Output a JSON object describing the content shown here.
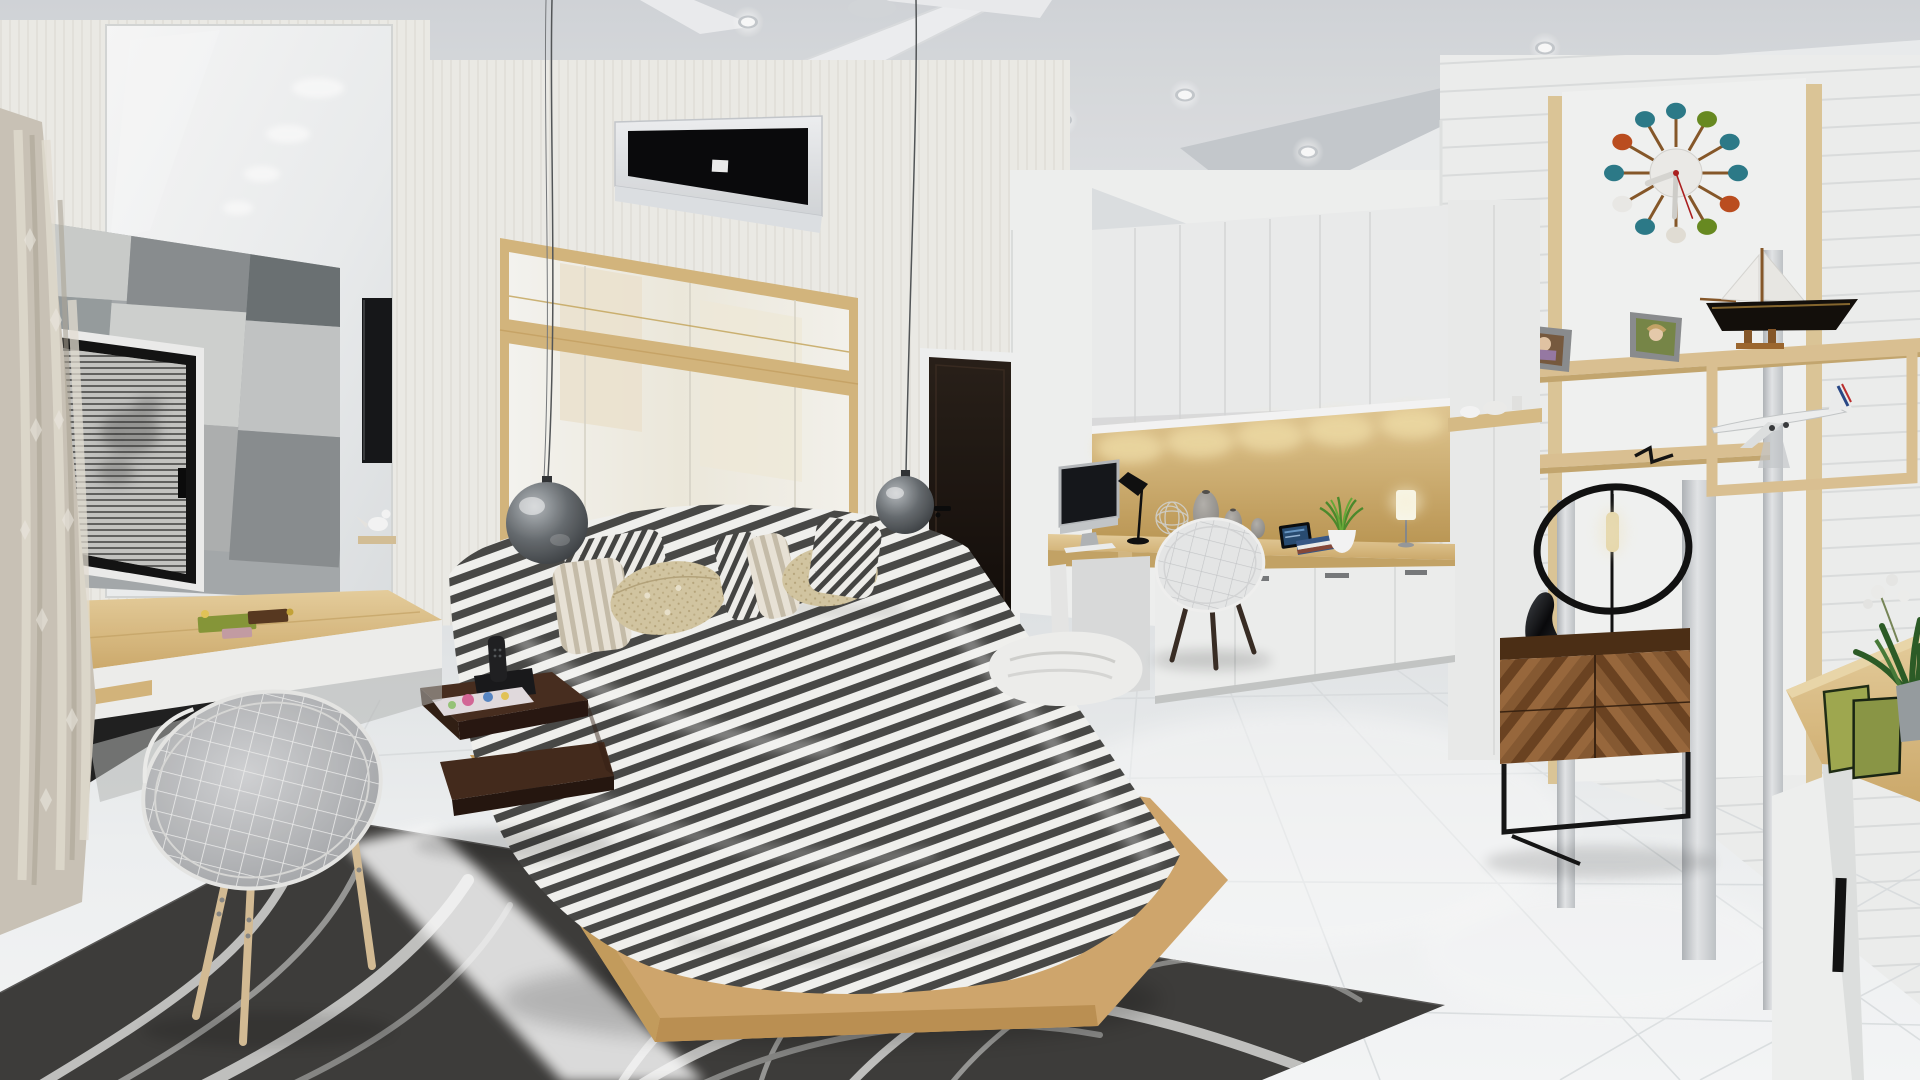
{
  "meta": {
    "title": "Modern bedroom interior — 3D architectural rendering",
    "style": "Contemporary Scandinavian bedroom with study nook, vanity and bathroom",
    "no_visible_text": true
  },
  "palette": {
    "ceiling": "#e7e9eb",
    "wall": "#f3f2ee",
    "wood_light": "#ddbf87",
    "wood_oak": "#d5ab70",
    "walnut": "#7a5230",
    "walnut_dark": "#4e3016",
    "rug": "#3f3e3c",
    "rug_wave_light": "#c6c6c4",
    "duvet_stripe": "#4b4b49",
    "duvet_base": "#f7f7f4",
    "pillow_beige": "#d8cba6",
    "floor": "#f2f4f6",
    "door": "#1d1511",
    "ac_panel": "#0b0b0d",
    "accent_teal": "#2e7d8c",
    "accent_green": "#6b8e23",
    "accent_orange": "#c05020"
  },
  "ceiling": {
    "downlights": [
      [
        920,
        80
      ],
      [
        1185,
        95
      ],
      [
        1308,
        152
      ],
      [
        1372,
        200
      ],
      [
        1545,
        48
      ],
      [
        1640,
        80
      ],
      [
        1062,
        120
      ],
      [
        748,
        22
      ]
    ]
  },
  "clock": {
    "center": [
      1676,
      173
    ],
    "spoke_radius": 62,
    "ball_radius": 10,
    "ball_colors": [
      "#2e7d8c",
      "#6b8e23",
      "#2e7d8c",
      "#2e7d8c",
      "#c05020",
      "#6b8e23",
      "#e8e4da",
      "#2e7d8c",
      "#f0efec",
      "#2e7d8c",
      "#c05020",
      "#2e7d8c"
    ],
    "stick_color": "#8a5a2b",
    "face_color": "#f2f1ee",
    "hour_angle_deg": 250,
    "minute_angle_deg": 182,
    "second_angle_deg": 160,
    "second_color": "#b02020"
  },
  "objects": [
    {
      "id": "ceiling-fan",
      "label": "white ceiling fan"
    },
    {
      "id": "recessed-downlights",
      "label": "recessed ceiling spotlights"
    },
    {
      "id": "air-conditioner",
      "label": "wall split air conditioner with black panel"
    },
    {
      "id": "pendant-lamp-left",
      "label": "smoked glass globe pendant lamp"
    },
    {
      "id": "pendant-lamp-right",
      "label": "smoked glass globe pendant lamp"
    },
    {
      "id": "headboard",
      "label": "glossy white headboard panel with oak trim"
    },
    {
      "id": "bed",
      "label": "double bed on oak platform"
    },
    {
      "id": "striped-duvet",
      "label": "black and white striped duvet"
    },
    {
      "id": "pillows",
      "label": "striped and beige tufted pillows"
    },
    {
      "id": "throw-towel",
      "label": "white folded towel on bed"
    },
    {
      "id": "nightstand",
      "label": "dark walnut floating nightstand"
    },
    {
      "id": "cordless-phone",
      "label": "black cordless phone on dock"
    },
    {
      "id": "magazine",
      "label": "colourful magazine"
    },
    {
      "id": "area-rug",
      "label": "charcoal rug with wavy ribbon pattern"
    },
    {
      "id": "vanity-desk",
      "label": "oak vanity desk with white drawer"
    },
    {
      "id": "vanity-chair",
      "label": "wire shell chair with grey cushion"
    },
    {
      "id": "vanity-mirror",
      "label": "glossy mirror reflecting ceiling lights"
    },
    {
      "id": "bathroom-tile-wall",
      "label": "grey patchwork concrete tile wall"
    },
    {
      "id": "shower-door",
      "label": "black framed slatted door with blurred portrait art"
    },
    {
      "id": "curtain",
      "label": "beige patterned curtain"
    },
    {
      "id": "bird-figurine",
      "label": "white bird figurine on ledge"
    },
    {
      "id": "wall-tv",
      "label": "wall mounted TV seen edge-on"
    },
    {
      "id": "interior-door",
      "label": "dark wenge interior door"
    },
    {
      "id": "study-desk",
      "label": "built-in oak study desk"
    },
    {
      "id": "imac-computer",
      "label": "all-in-one desktop computer"
    },
    {
      "id": "desk-lamp",
      "label": "black AJ desk lamp"
    },
    {
      "id": "wire-sphere",
      "label": "decorative wire sphere"
    },
    {
      "id": "vases",
      "label": "speckled grey vases"
    },
    {
      "id": "tablet",
      "label": "tablet on stand"
    },
    {
      "id": "book-stack",
      "label": "stack of books"
    },
    {
      "id": "potted-grass",
      "label": "grass plant in white pot"
    },
    {
      "id": "table-lamp",
      "label": "white cylinder table lamp"
    },
    {
      "id": "desk-chair",
      "label": "wire shell desk chair with walnut legs"
    },
    {
      "id": "upper-cabinets",
      "label": "white overhead cabinets"
    },
    {
      "id": "wood-backsplash",
      "label": "oak backsplash with under-cabinet lighting"
    },
    {
      "id": "base-cabinets",
      "label": "white base cabinets"
    },
    {
      "id": "wall-shelves",
      "label": "oak wall shelves"
    },
    {
      "id": "photo-frames",
      "label": "two grey photo frames"
    },
    {
      "id": "teddy-bear",
      "label": "dark red teddy bear"
    },
    {
      "id": "paper-stack",
      "label": "stack of papers"
    },
    {
      "id": "model-sailboat",
      "label": "black hulled model sailboat"
    },
    {
      "id": "model-airplane",
      "label": "white airliner model with blue and red tail"
    },
    {
      "id": "shelf-frame",
      "label": "oak box display frame"
    },
    {
      "id": "ball-clock",
      "label": "mid-century ball wall clock"
    },
    {
      "id": "mirror-strips",
      "label": "vertical mirror strips on plank wall"
    },
    {
      "id": "chevron-chest",
      "label": "walnut chevron chest on black metal frame"
    },
    {
      "id": "ring-lamp",
      "label": "black ring table lamp with tube bulb"
    },
    {
      "id": "sculpture",
      "label": "black twisted sculpture"
    },
    {
      "id": "tv-console",
      "label": "oak and white media console"
    },
    {
      "id": "green-books",
      "label": "green leaning books"
    },
    {
      "id": "plant-pot",
      "label": "plant and white orchid in grey pot"
    },
    {
      "id": "tile-floor",
      "label": "glossy white tile floor"
    }
  ]
}
